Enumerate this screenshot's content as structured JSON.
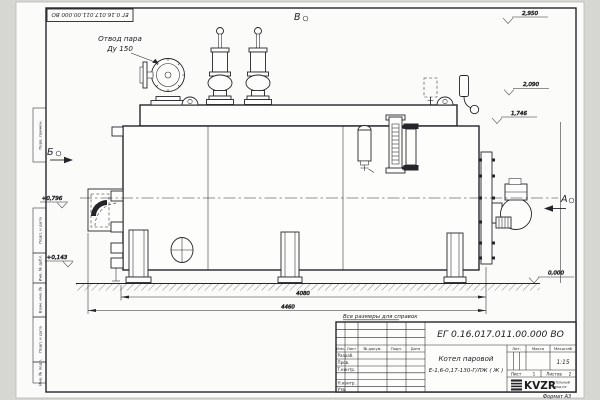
{
  "sheet": {
    "top_stamp": "ЕГ 0.16.017.011.00.000  ВО",
    "format_label": "Формат А3",
    "side_column": {
      "cell_top": "Перв. примен.",
      "cells": [
        "Подп. и дата",
        "Инв. № дубл.",
        "Взам. инв. №",
        "Подп. и дата",
        "Инв. № подл."
      ]
    }
  },
  "drawing": {
    "callout": {
      "line1": "Отвод пара",
      "line2": "Ду 150"
    },
    "view_markers": {
      "top": "В",
      "left": "Б",
      "right": "А"
    },
    "elevations": {
      "top1": "2,950",
      "top2": "2,090",
      "top3": "1,746",
      "ground": "0,000",
      "left_upper": "+0,796",
      "left_lower": "+0,143"
    },
    "dimensions": {
      "inner": "4080",
      "outer": "4460"
    },
    "note": "Все размеры для справок"
  },
  "title_block": {
    "doc_number": "ЕГ 0.16.017.011.00.000  ВО",
    "name_line1": "Котел паровой",
    "name_line2": "Е-1,6-0,17-130-Г/ЛЖ ( Ж )",
    "header_row": {
      "izm": "Изм.",
      "list": "Лист",
      "doc": "№ докум.",
      "sign": "Подп.",
      "date": "Дата"
    },
    "roles": [
      "Разраб.",
      "Пров.",
      "Т.контр.",
      "Н.контр.",
      "Утв."
    ],
    "lit_label": "Лит.",
    "mass_label": "Масса",
    "scale_label": "Масштаб",
    "scale_value": "1:15",
    "sheet_label": "Лист",
    "sheet_value": "1",
    "sheets_label": "Листов",
    "sheets_value": "2",
    "logo": "KVZR",
    "logo_caption1": "КОТЕЛЬНЫЙ",
    "logo_caption2": "ЗАВОД РФ"
  }
}
